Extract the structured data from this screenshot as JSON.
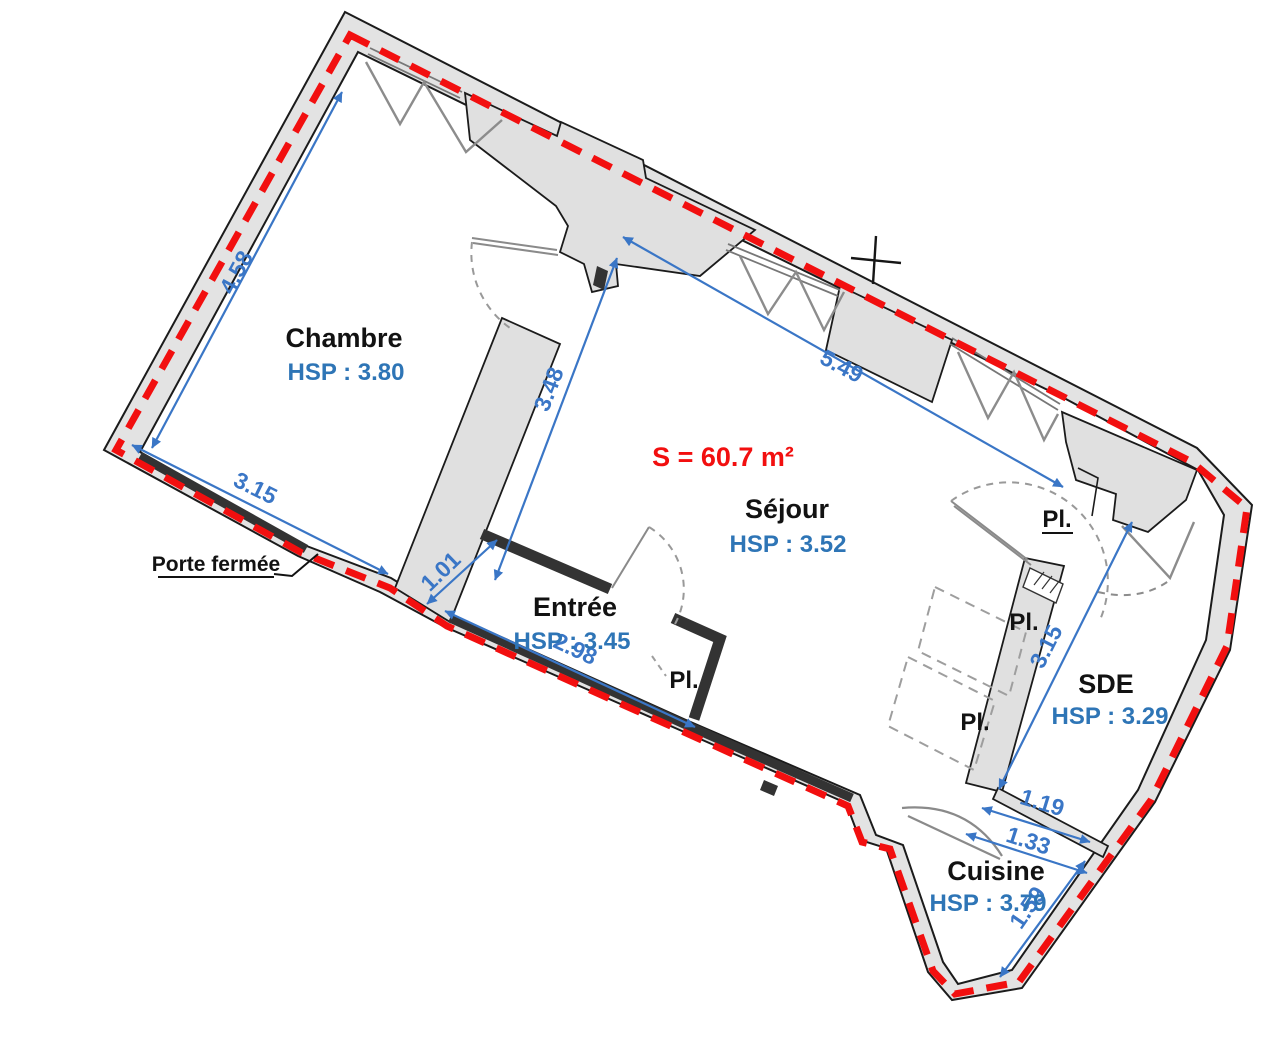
{
  "plan": {
    "area_label": "S = 60.7 m²",
    "door_note": "Porte fermée",
    "closet_label": "Pl.",
    "rooms": [
      {
        "name": "Chambre",
        "hsp": "HSP : 3.80"
      },
      {
        "name": "Séjour",
        "hsp": "HSP : 3.52"
      },
      {
        "name": "Entrée",
        "hsp": "HSP : 3.45"
      },
      {
        "name": "SDE",
        "hsp": "HSP : 3.29"
      },
      {
        "name": "Cuisine",
        "hsp": "HSP : 3.79"
      }
    ],
    "dimensions": {
      "chambre_left": "4.58",
      "chambre_bottom": "3.15",
      "sejour_left": "3.48",
      "sejour_top": "5.49",
      "entree_left": "1.01",
      "entree_bottom": "2.98",
      "sde_left": "3.15",
      "sde_bottom_inner": "1.19",
      "sde_bottom_outer": "1.33",
      "cuisine_right": "1.59"
    },
    "colors": {
      "dimension_blue": "#3a76c6",
      "hsp_blue": "#2e75b6",
      "area_red": "#f20f0f",
      "perimeter_red": "#f20f0f",
      "wall_gray": "#e3e3e3",
      "dark_wall": "#333333"
    }
  }
}
